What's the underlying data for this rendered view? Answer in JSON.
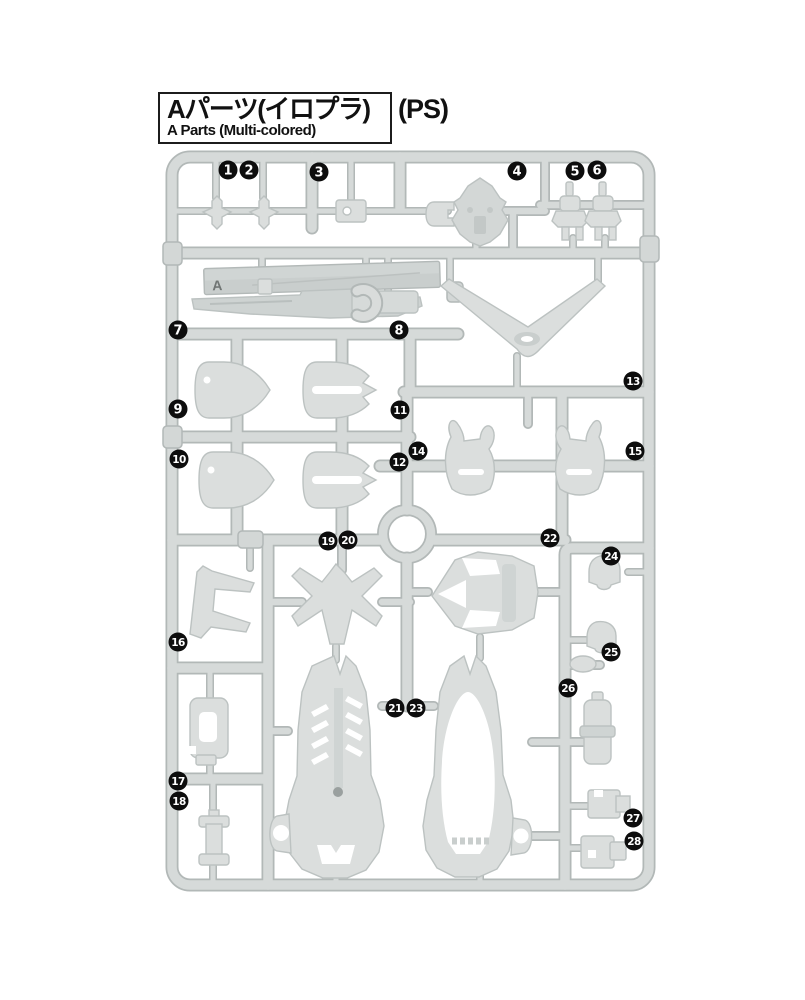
{
  "header": {
    "title_jp": "Aパーツ(イロプラ)",
    "title_en": "A Parts (Multi-colored)",
    "material": "(PS)"
  },
  "runner": {
    "plate_letter": "A",
    "colors": {
      "bar_fill": "#d6dad9",
      "bar_edge": "#b2b8b7",
      "part_fill": "#dbdedd",
      "part_edge": "#bcc2c1",
      "badge_bg": "#0d0d0d",
      "badge_text": "#ffffff"
    },
    "badges": [
      {
        "n": "1",
        "x": 228,
        "y": 170
      },
      {
        "n": "2",
        "x": 249,
        "y": 170
      },
      {
        "n": "3",
        "x": 319,
        "y": 172
      },
      {
        "n": "4",
        "x": 517,
        "y": 171
      },
      {
        "n": "5",
        "x": 575,
        "y": 171
      },
      {
        "n": "6",
        "x": 597,
        "y": 170
      },
      {
        "n": "7",
        "x": 178,
        "y": 330
      },
      {
        "n": "8",
        "x": 399,
        "y": 330
      },
      {
        "n": "9",
        "x": 178,
        "y": 409
      },
      {
        "n": "10",
        "x": 179,
        "y": 459
      },
      {
        "n": "11",
        "x": 400,
        "y": 410
      },
      {
        "n": "12",
        "x": 399,
        "y": 462
      },
      {
        "n": "13",
        "x": 633,
        "y": 381
      },
      {
        "n": "14",
        "x": 418,
        "y": 451
      },
      {
        "n": "15",
        "x": 635,
        "y": 451
      },
      {
        "n": "16",
        "x": 178,
        "y": 642
      },
      {
        "n": "17",
        "x": 178,
        "y": 781
      },
      {
        "n": "18",
        "x": 179,
        "y": 801
      },
      {
        "n": "19",
        "x": 328,
        "y": 541
      },
      {
        "n": "20",
        "x": 348,
        "y": 540
      },
      {
        "n": "21",
        "x": 395,
        "y": 708
      },
      {
        "n": "22",
        "x": 550,
        "y": 538
      },
      {
        "n": "23",
        "x": 416,
        "y": 708
      },
      {
        "n": "24",
        "x": 611,
        "y": 556
      },
      {
        "n": "25",
        "x": 611,
        "y": 652
      },
      {
        "n": "26",
        "x": 568,
        "y": 688
      },
      {
        "n": "27",
        "x": 633,
        "y": 818
      },
      {
        "n": "28",
        "x": 634,
        "y": 841
      }
    ]
  }
}
